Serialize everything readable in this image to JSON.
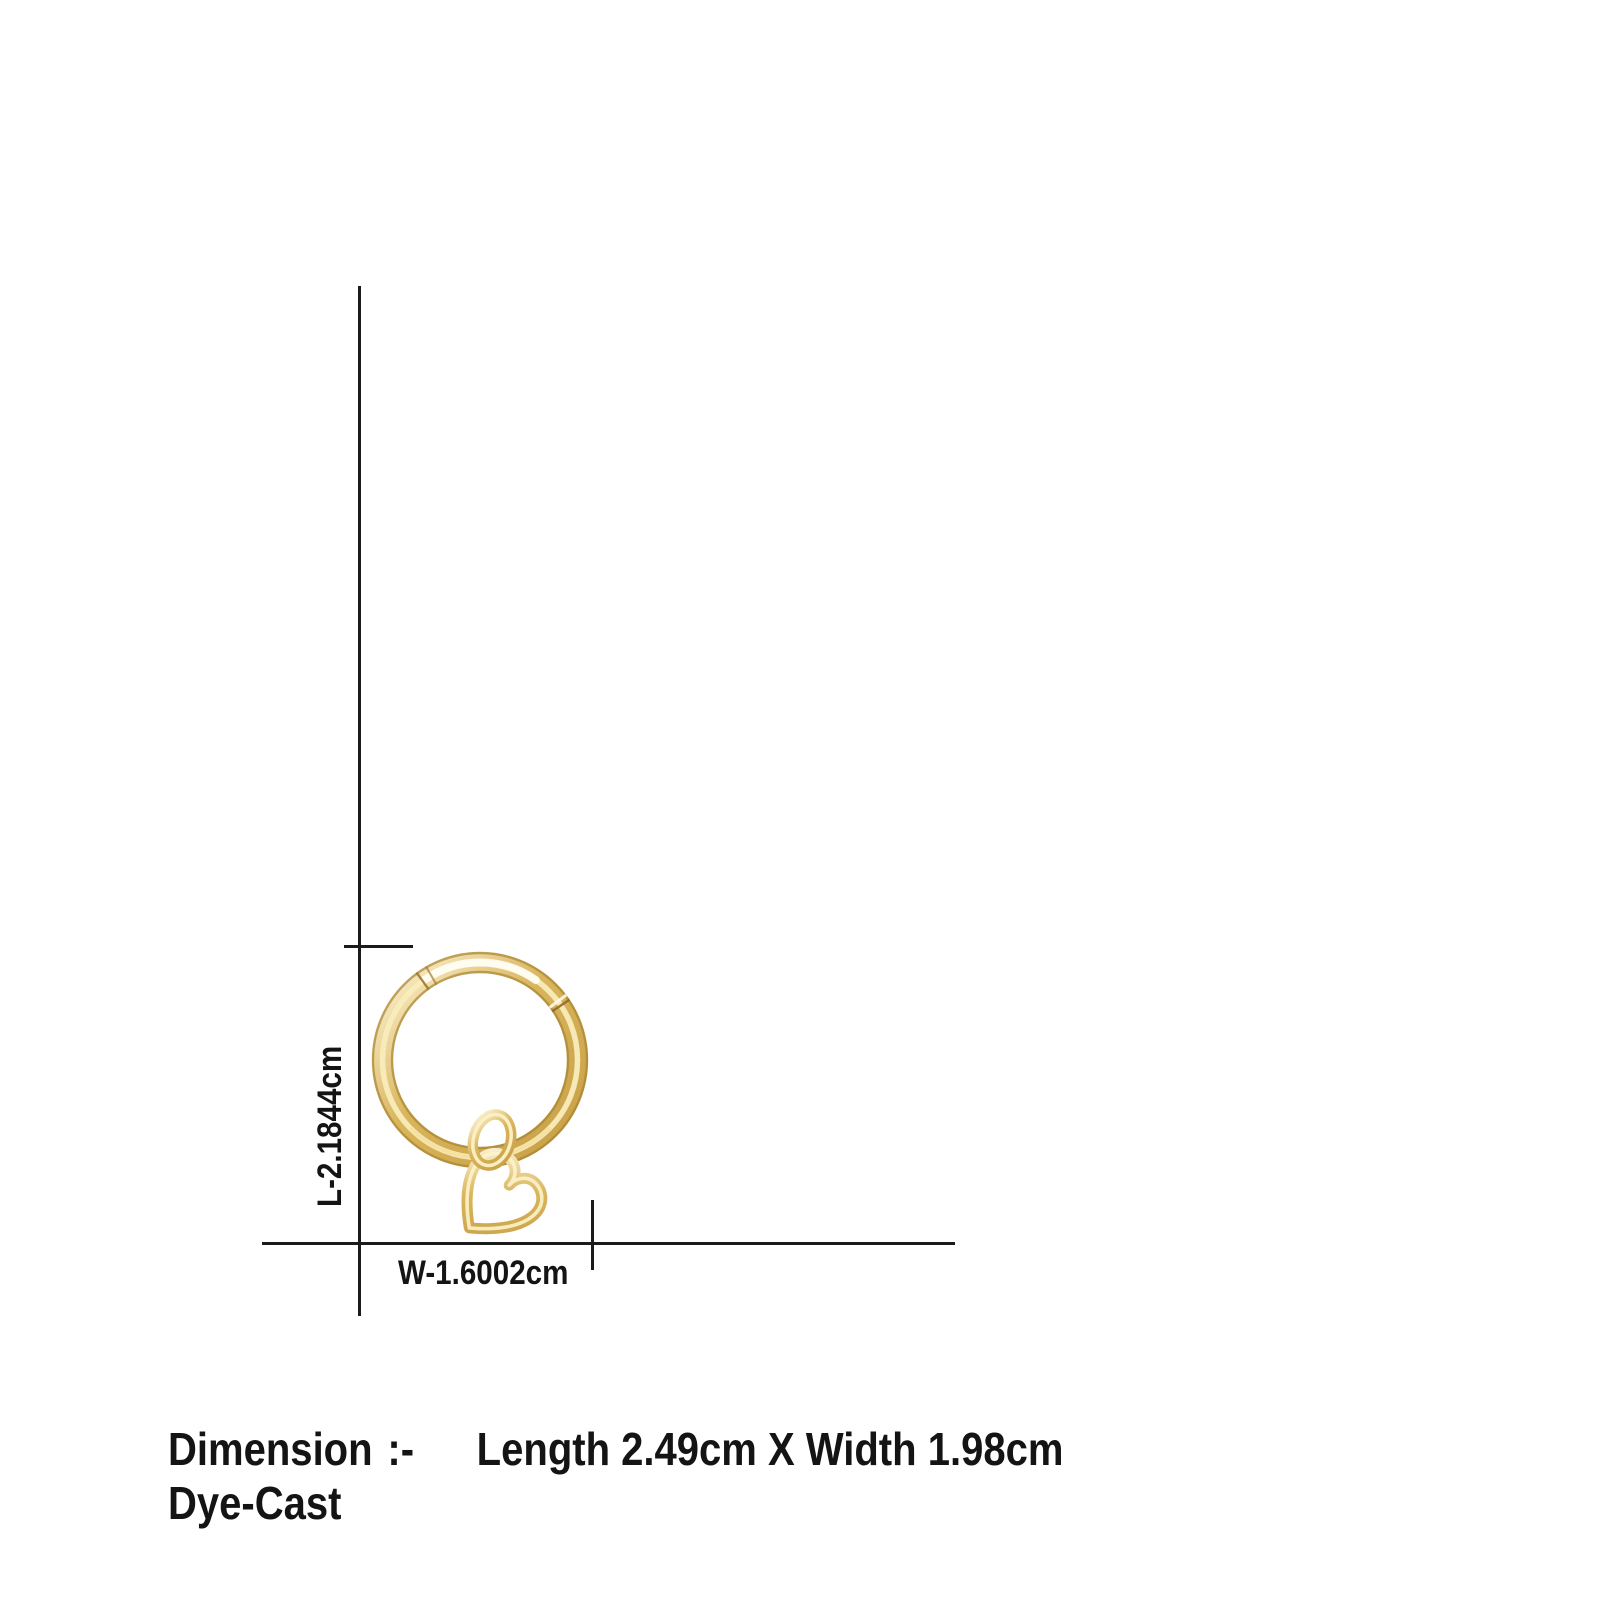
{
  "diagram": {
    "length_label": "L-2.1844cm",
    "width_label": "W-1.6002cm"
  },
  "product": {
    "image_name": "gold-hoop-earring-with-heart-charm",
    "colors": {
      "gold_light": "#fdf5d9",
      "gold_highlight": "#f9ecbb",
      "gold_base": "#d9b55c",
      "gold_deep": "#c79f47",
      "gold_edge": "#a8842f"
    }
  },
  "footer": {
    "heading": "Dimension",
    "separator": ":-",
    "dimensions": "Length 2.49cm X Width 1.98cm",
    "material": "Dye-Cast"
  },
  "style": {
    "background": "#ffffff",
    "line_color": "#1b1b1b",
    "text_color": "#141414"
  }
}
